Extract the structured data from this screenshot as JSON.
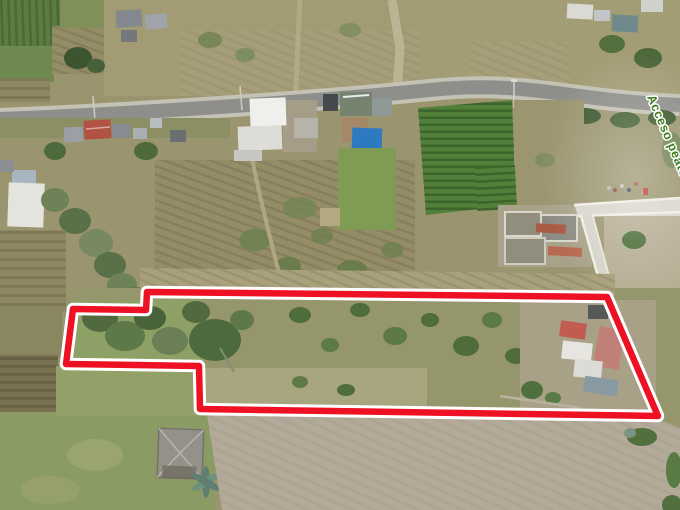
{
  "annotation": {
    "boundary": {
      "points": "147,292 607,297 658,416 200,409 199,366 66,364 73,309 146,310",
      "stroke_color": "#ee1123",
      "casing_color": "#ffffff",
      "stroke_width": "6.5",
      "casing_width": "12.5"
    },
    "access_label": {
      "text": "Acceso peatonal",
      "color": "#3e7d1e",
      "outline_color": "#ffffff"
    }
  }
}
